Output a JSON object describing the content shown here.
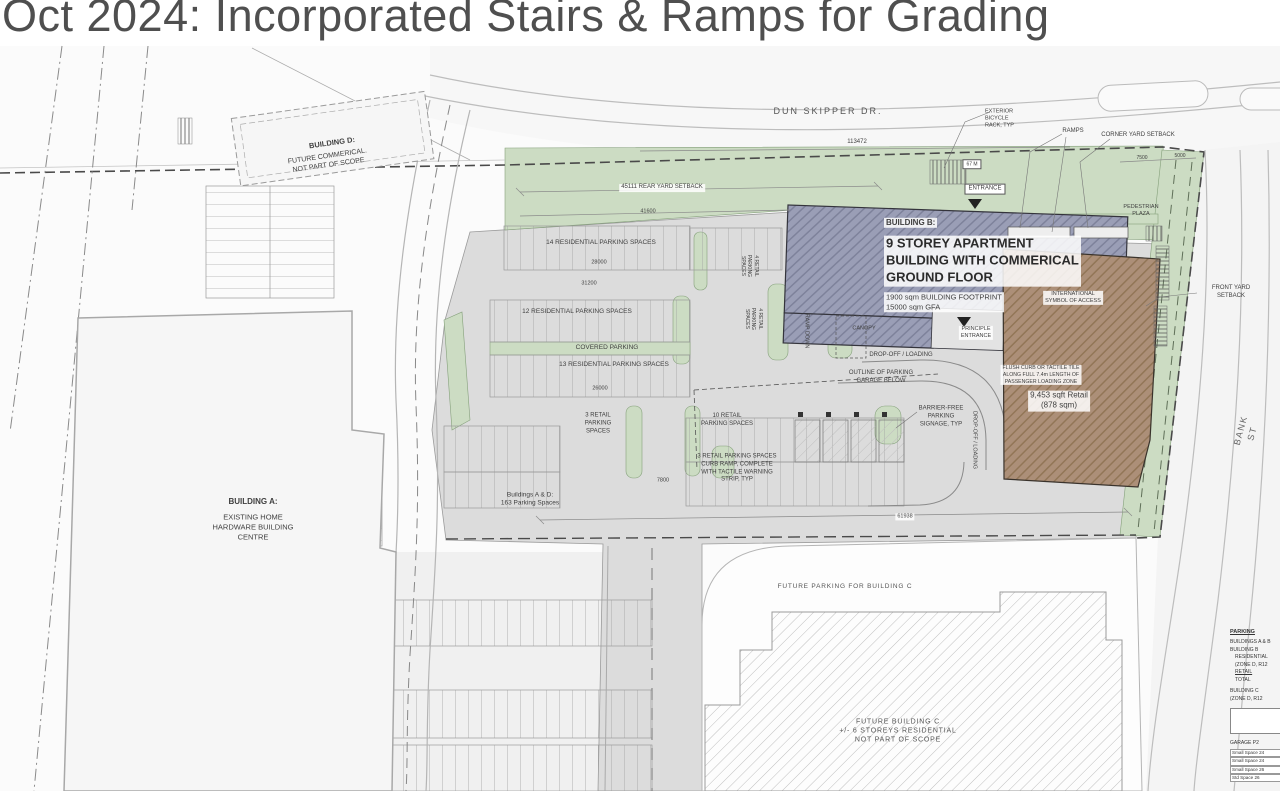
{
  "title": "Oct 2024: Incorporated Stairs & Ramps for Grading",
  "roads": {
    "dun_skipper_dr": "DUN SKIPPER DR.",
    "bank_st": "BANK ST"
  },
  "buildings": {
    "a_heading": "BUILDING A:",
    "a_body": "EXISTING HOME\nHARDWARE BUILDING\nCENTRE",
    "b_heading": "BUILDING B:",
    "b_body": "9 STOREY APARTMENT\nBUILDING WITH COMMERICAL\nGROUND FLOOR",
    "b_stats": "1900 sqm BUILDING FOOTPRINT\n15000 sqm GFA",
    "c_label": "FUTURE BUILDING C\n+/- 6 STOREYS RESIDENTIAL\nNOT PART OF SCOPE",
    "d_heading": "BUILDING D:",
    "d_body": "FUTURE COMMERICAL.\nNOT PART OF SCOPE"
  },
  "parking": {
    "res14": "14 RESIDENTIAL PARKING SPACES",
    "res12": "12 RESIDENTIAL PARKING SPACES",
    "covered": "COVERED PARKING",
    "res13": "13 RESIDENTIAL PARKING SPACES",
    "retail3": "3 RETAIL\nPARKING\nSPACES",
    "retail10": "10 RETAIL\nPARKING SPACES",
    "retail3_curb": "3 RETAIL PARKING SPACES\nCURB RAMP, COMPLETE\nWITH TACTILE WARNING\nSTRIP, TYP",
    "retail4": "4 RETAIL\nPARKING\nSPACES",
    "totals_ad": "Buildings A & D:\n163 Parking Spaces",
    "future_c": "FUTURE PARKING FOR BUILDING C"
  },
  "annotations": {
    "exterior_bicycle_rack": "EXTERIOR\nBICYCLE\nRACK, TYP",
    "ramps": "RAMPS",
    "corner_yard_setback": "CORNER YARD SETBACK",
    "entrance": "ENTRANCE",
    "bike_area": "67 M",
    "pedestrian_plaza": "PEDESTRIAN\nPLAZA",
    "front_yard_setback": "FRONT YARD SETBACK",
    "ramp_down": "RAMP DOWN",
    "canopy": "CANOPY",
    "drop_off_loading": "DROP-OFF / LOADING",
    "garage_outline": "OUTLINE OF PARKING\nGARAGE BELOW",
    "barrier_free": "BARRIER-FREE\nPARKING\nSIGNAGE, TYP",
    "intl_symbol": "INTERNATIONAL\nSYMBOL OF ACCESS",
    "principle_entrance": "PRINCIPLE\nENTRANCE",
    "flush_curb": "FLUSH CURB OR TACTILE TILE\nALONG FULL 7.4m LENGTH OF\nPASSENGER LOADING ZONE",
    "retail_area": "9,453 sqft Retail\n(878 sqm)"
  },
  "dimensions": {
    "top_road": "113472",
    "rear_setback": "45111 REAR YARD SETBACK",
    "setback_width": "41600",
    "aisle": "31200",
    "stall_run": "28000",
    "lot_width": "26000",
    "drive": "7800",
    "south": "61938",
    "corner_a": "7500",
    "corner_b": "5000"
  },
  "legend": {
    "heading": "PARKING",
    "lines": [
      "BUILDINGS A & B",
      "BUILDING B",
      "RESIDENTIAL",
      "(ZONE D, R12",
      "RETAIL",
      "TOTAL",
      "BUILDING C",
      "(ZONE D, R12"
    ],
    "garage_heading": "GARAGE P2",
    "garage_rows": [
      "Small Space 24",
      "Small Space 24",
      "Small Space 26",
      "Std Space 26"
    ]
  },
  "colors": {
    "green": "#ccdcc3",
    "building_b": "#9a9eb6",
    "building_retail": "#ac8f78",
    "asphalt": "#dcdcdc"
  }
}
